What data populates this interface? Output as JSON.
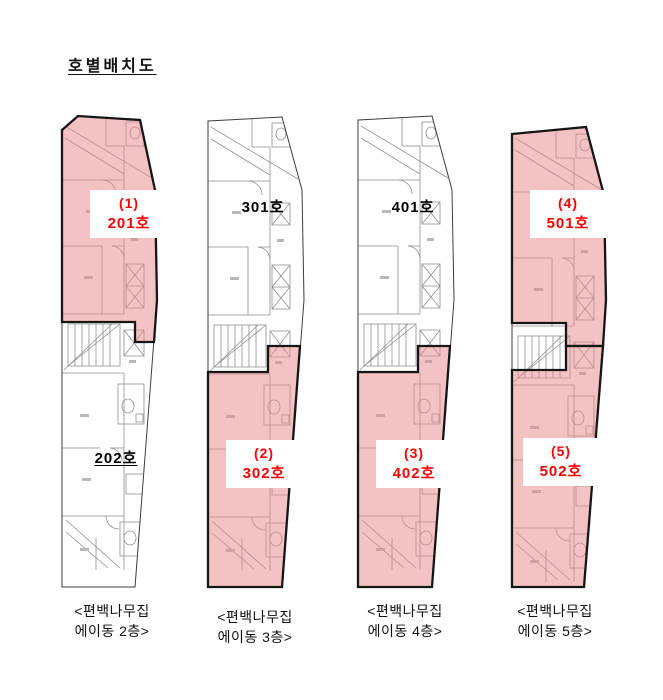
{
  "title": "호별배치도",
  "colors": {
    "highlight_fill": "#f3c6c6",
    "highlight_text": "#ff0000",
    "plan_line": "#8f8f8f",
    "outline": "#161616",
    "text": "#111111"
  },
  "plans": [
    {
      "caption1": "<편백나무집",
      "caption2": "에이동 2층>",
      "units": [
        {
          "no": "(1)",
          "room": "201호",
          "highlighted": true
        },
        {
          "no": "",
          "room": "202호",
          "highlighted": false
        }
      ]
    },
    {
      "caption1": "<편백나무집",
      "caption2": "에이동 3층>",
      "units": [
        {
          "no": "",
          "room": "301호",
          "highlighted": false
        },
        {
          "no": "(2)",
          "room": "302호",
          "highlighted": true
        }
      ]
    },
    {
      "caption1": "<편백나무집",
      "caption2": "에이동 4층>",
      "units": [
        {
          "no": "",
          "room": "401호",
          "highlighted": false
        },
        {
          "no": "(3)",
          "room": "402호",
          "highlighted": true
        }
      ]
    },
    {
      "caption1": "<편백나무집",
      "caption2": "에이동 5층>",
      "units": [
        {
          "no": "(4)",
          "room": "501호",
          "highlighted": true
        },
        {
          "no": "(5)",
          "room": "502호",
          "highlighted": true
        }
      ]
    }
  ]
}
